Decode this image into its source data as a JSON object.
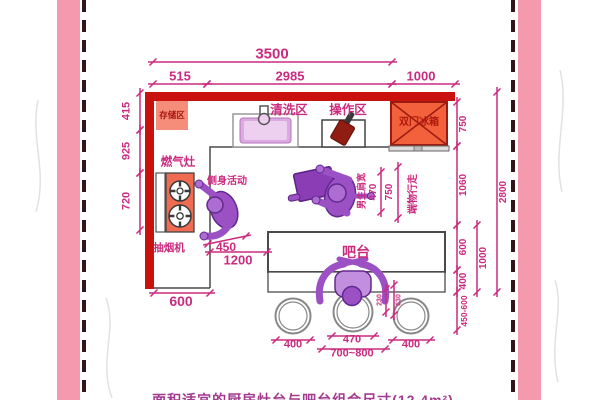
{
  "colors": {
    "accent_pink": "#cb2b7f",
    "wall_red": "#c9110e",
    "frame_band": "#f59aae",
    "frame_dash": "#30161b",
    "appliance_salmon": "#f58d7a",
    "fridge_orange": "#f2603c",
    "person_purple": "#9b51c4",
    "sink_plum": "#dca9e0"
  },
  "dims": {
    "total_width": "3500",
    "left_run": "515",
    "main_run": "2985",
    "fridge_zone": "1000",
    "storage_depth": "415",
    "wall_gap": "925",
    "stove_run": "720",
    "fridge_depth": "750",
    "walkway": "1060",
    "bar_depth": "600",
    "overhang": "400",
    "stool_zone": "450-600",
    "bar_total": "1000",
    "room_depth": "2800",
    "shoulder_width": "470",
    "carry_walk": "750",
    "side_turn": "450",
    "aisle": "1200",
    "counter_depth": "600",
    "stool_left": "400",
    "stool_seat": "470",
    "seat_pitch": "700~800",
    "stool_right": "400",
    "knee_space": "230",
    "seat_depth": "630"
  },
  "labels": {
    "storage": "存储区",
    "washing": "清洗区",
    "operation": "操作区",
    "fridge": "双门冰箱",
    "stove": "燃气灶",
    "hood": "抽烟机",
    "side_activity": "侧身活动",
    "bar": "吧台",
    "shoulder": "男生肩宽",
    "carry": "端物行走"
  },
  "caption": "面积适宜的厨房灶台与吧台组合尺寸(12.4m²)"
}
